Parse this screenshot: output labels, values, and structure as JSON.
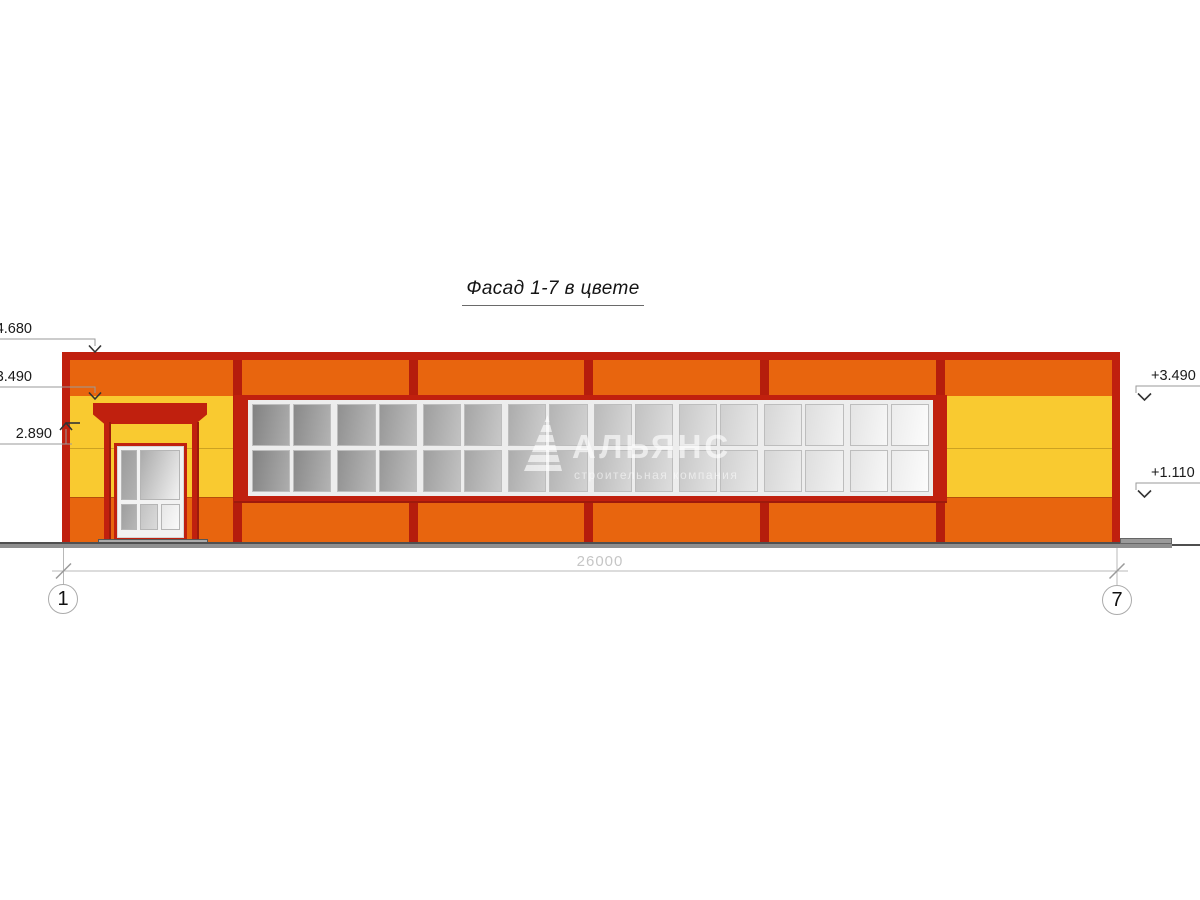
{
  "title": "Фасад 1-7 в цвете",
  "watermark": {
    "logo": "sail-triangle",
    "name": "АЛЬЯНС",
    "tagline": "строительная компания"
  },
  "elevations": {
    "left": [
      {
        "label": "4.680"
      },
      {
        "label": "3.490"
      },
      {
        "label": "2.890"
      }
    ],
    "right": [
      {
        "label": "+3.490"
      },
      {
        "label": "+1.110"
      }
    ]
  },
  "dimension": {
    "length": "26000"
  },
  "axes": {
    "first": "1",
    "last": "7"
  },
  "colors": {
    "dark_red": "#C0200E",
    "orange": "#E8650E",
    "yellow": "#F9CA30",
    "glass_dark": "#8A8A8A",
    "glass_light": "#FBFBFB"
  },
  "window_band": {
    "rows": 2,
    "groups": 8,
    "panes_per_group": 2
  },
  "door": {
    "pane_colors": [
      {
        "from": "#9b9b9b",
        "to": "#b2b2b2"
      },
      {
        "from": "#ababab",
        "to": "#f2f2f2"
      },
      {
        "from": "#9e9e9e",
        "to": "#b6b6b6"
      },
      {
        "from": "#c2c2c2",
        "to": "#dadada"
      },
      {
        "from": "#e6e6e6",
        "to": "#fafafa"
      }
    ]
  }
}
